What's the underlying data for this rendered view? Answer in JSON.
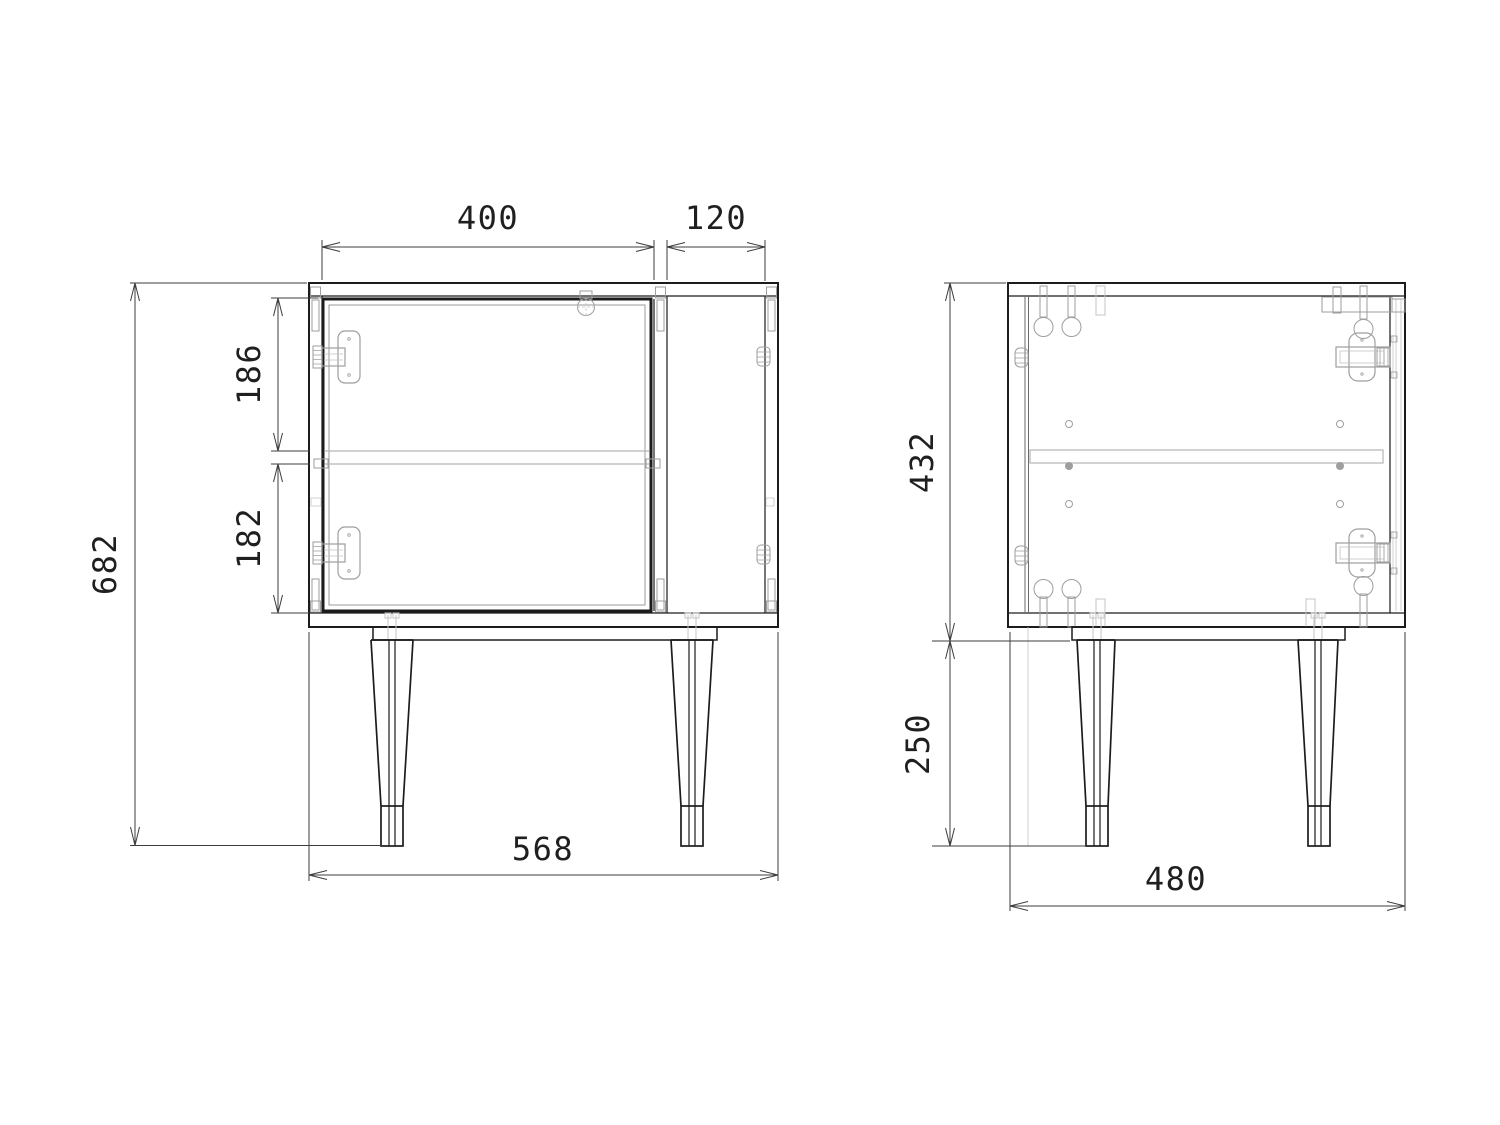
{
  "page": {
    "background": "#ffffff"
  },
  "colors": {
    "line": "#1c1c1c",
    "hardware": "#9e9e9e",
    "hardware_light": "#c4c4c4",
    "hidden": "#b5b5b5",
    "dimension": "#3d3d3d",
    "text": "#1f1f1f",
    "background": "#ffffff"
  },
  "views": {
    "front": {
      "name": "front view"
    },
    "side": {
      "name": "side view"
    }
  },
  "dimensions": {
    "door_width": {
      "value": "400",
      "orientation": "horizontal"
    },
    "niche_width": {
      "value": "120",
      "orientation": "horizontal"
    },
    "upper_opening_height": {
      "value": "186",
      "orientation": "vertical"
    },
    "lower_opening_height": {
      "value": "182",
      "orientation": "vertical"
    },
    "overall_height": {
      "value": "682",
      "orientation": "vertical"
    },
    "overall_width": {
      "value": "568",
      "orientation": "horizontal"
    },
    "carcass_height": {
      "value": "432",
      "orientation": "vertical"
    },
    "leg_height": {
      "value": "250",
      "orientation": "vertical"
    },
    "depth": {
      "value": "480",
      "orientation": "horizontal"
    }
  }
}
